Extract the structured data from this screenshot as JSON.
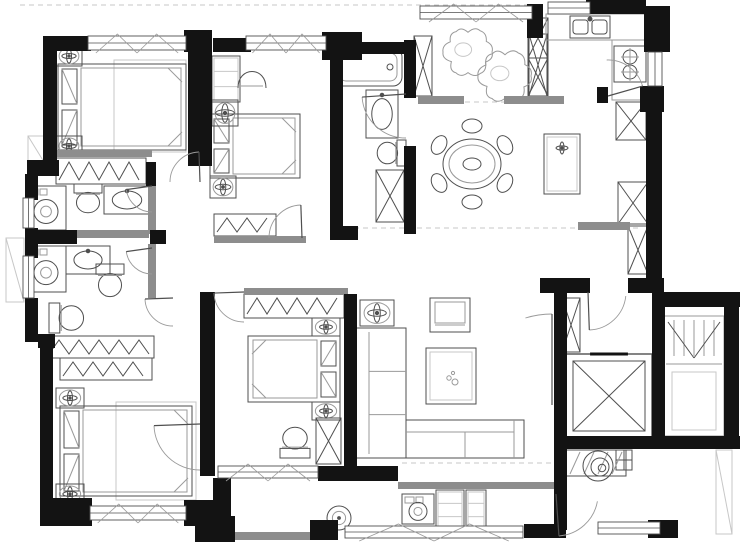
{
  "meta": {
    "canvas_w": 740,
    "canvas_h": 550,
    "drawing_type": "apartment-floor-plan"
  },
  "palette": {
    "wall": "#131313",
    "gray": "#8d8d8d",
    "line": "#4f4f4f",
    "light": "#9a9a9a",
    "faint": "#c7c7c7",
    "white": "#ffffff"
  },
  "dashes": [
    [
      20,
      5,
      528,
      5
    ],
    [
      345,
      228,
      642,
      228
    ],
    [
      420,
      102,
      510,
      102
    ],
    [
      402,
      463,
      552,
      463
    ]
  ],
  "walls": [
    [
      43,
      36,
      48,
      15
    ],
    [
      43,
      36,
      14,
      128
    ],
    [
      27,
      160,
      32,
      16
    ],
    [
      25,
      174,
      13,
      26
    ],
    [
      25,
      228,
      13,
      30
    ],
    [
      25,
      298,
      13,
      44
    ],
    [
      25,
      230,
      52,
      14
    ],
    [
      150,
      230,
      16,
      14
    ],
    [
      38,
      334,
      17,
      14
    ],
    [
      40,
      340,
      13,
      164
    ],
    [
      40,
      498,
      52,
      28
    ],
    [
      184,
      500,
      30,
      26
    ],
    [
      146,
      162,
      10,
      24
    ],
    [
      184,
      30,
      28,
      22
    ],
    [
      188,
      36,
      24,
      130
    ],
    [
      213,
      38,
      38,
      14
    ],
    [
      322,
      32,
      40,
      28
    ],
    [
      330,
      48,
      13,
      186
    ],
    [
      342,
      42,
      66,
      12
    ],
    [
      404,
      40,
      12,
      58
    ],
    [
      404,
      146,
      12,
      88
    ],
    [
      330,
      226,
      28,
      14
    ],
    [
      527,
      4,
      16,
      34
    ],
    [
      586,
      0,
      60,
      14
    ],
    [
      644,
      6,
      26,
      46
    ],
    [
      640,
      86,
      24,
      26
    ],
    [
      646,
      90,
      16,
      192
    ],
    [
      540,
      278,
      50,
      15
    ],
    [
      628,
      278,
      36,
      15
    ],
    [
      554,
      292,
      13,
      66
    ],
    [
      554,
      352,
      13,
      90
    ],
    [
      554,
      436,
      112,
      13
    ],
    [
      652,
      304,
      13,
      136
    ],
    [
      652,
      292,
      88,
      15
    ],
    [
      724,
      304,
      15,
      138
    ],
    [
      664,
      436,
      76,
      13
    ],
    [
      554,
      448,
      13,
      82
    ],
    [
      648,
      520,
      30,
      18
    ],
    [
      597,
      87,
      11,
      16
    ],
    [
      200,
      292,
      15,
      184
    ],
    [
      344,
      294,
      13,
      176
    ],
    [
      318,
      466,
      80,
      15
    ],
    [
      213,
      478,
      18,
      46
    ],
    [
      195,
      516,
      40,
      26
    ],
    [
      310,
      520,
      28,
      20
    ],
    [
      524,
      524,
      42,
      14
    ]
  ],
  "gray_walls": [
    [
      148,
      184,
      8,
      50
    ],
    [
      77,
      230,
      72,
      8
    ],
    [
      148,
      244,
      8,
      54
    ],
    [
      56,
      150,
      96,
      7
    ],
    [
      214,
      236,
      92,
      7
    ],
    [
      244,
      288,
      104,
      7
    ],
    [
      418,
      96,
      46,
      8
    ],
    [
      504,
      96,
      60,
      8
    ],
    [
      578,
      222,
      52,
      8
    ],
    [
      398,
      482,
      160,
      7
    ],
    [
      233,
      532,
      80,
      8
    ]
  ],
  "windows": [
    {
      "n": "window-bedroom-1",
      "x": 88,
      "y": 36,
      "w": 98,
      "h": 14,
      "tick": true
    },
    {
      "n": "window-bedroom-2",
      "x": 246,
      "y": 36,
      "w": 80,
      "h": 14,
      "tick": true
    },
    {
      "n": "window-balcony-top",
      "x": 420,
      "y": 6,
      "w": 112,
      "h": 13,
      "tick": true
    },
    {
      "n": "window-kitchen-top",
      "x": 548,
      "y": 2,
      "w": 42,
      "h": 12
    },
    {
      "n": "window-kitchen-right",
      "x": 648,
      "y": 52,
      "w": 14,
      "h": 34,
      "v": true
    },
    {
      "n": "window-bath-a",
      "x": 23,
      "y": 198,
      "w": 11,
      "h": 30,
      "v": true
    },
    {
      "n": "window-bath-b",
      "x": 23,
      "y": 256,
      "w": 11,
      "h": 42,
      "v": true
    },
    {
      "n": "window-bedroom-3",
      "x": 90,
      "y": 506,
      "w": 96,
      "h": 14,
      "tick": true
    },
    {
      "n": "window-balcony-bottom",
      "x": 345,
      "y": 526,
      "w": 178,
      "h": 12,
      "tick": true
    },
    {
      "n": "window-lobby-bottom",
      "x": 598,
      "y": 522,
      "w": 62,
      "h": 12
    },
    {
      "n": "window-master-balcony",
      "x": 218,
      "y": 466,
      "w": 100,
      "h": 12,
      "tick": true
    }
  ],
  "doors": [
    {
      "n": "door-bedroom-1",
      "cx": 200,
      "cy": 182,
      "r": 30,
      "a0": 180,
      "a1": 268
    },
    {
      "n": "door-bath-a",
      "cx": 152,
      "cy": 186,
      "r": 26,
      "a0": 90,
      "a1": 172
    },
    {
      "n": "door-bath-b",
      "cx": 152,
      "cy": 248,
      "r": 26,
      "a0": 90,
      "a1": 172
    },
    {
      "n": "door-dressing",
      "cx": 173,
      "cy": 298,
      "r": 28,
      "a0": 90,
      "a1": 178
    },
    {
      "n": "door-bedroom-2",
      "cx": 302,
      "cy": 238,
      "r": 33,
      "a0": 180,
      "a1": 268
    },
    {
      "n": "door-bath-2",
      "cx": 406,
      "cy": 94,
      "r": 44,
      "a0": 90,
      "a1": 176
    },
    {
      "n": "door-kitchen",
      "cx": 608,
      "cy": 96,
      "r": 36,
      "a0": 268,
      "a1": 344
    },
    {
      "n": "door-master",
      "cx": 244,
      "cy": 292,
      "r": 30,
      "a0": 90,
      "a1": 178
    },
    {
      "n": "door-bedroom-3",
      "cx": 200,
      "cy": 424,
      "r": 46,
      "a0": 90,
      "a1": 178
    },
    {
      "n": "door-entry",
      "cx": 588,
      "cy": 292,
      "r": 38,
      "a0": 6,
      "a1": 88
    },
    {
      "n": "door-living-lobby",
      "cx": 552,
      "cy": 405,
      "r": 91,
      "a0": 253,
      "a1": 270
    },
    {
      "n": "door-lobby-lower",
      "cx": 556,
      "cy": 494,
      "r": 42,
      "a0": 10,
      "a1": 86
    }
  ],
  "items": [
    {
      "t": "platform",
      "n": "exterior-ledge-left-upper",
      "x": 28,
      "y": 136,
      "w": 16,
      "h": 26
    },
    {
      "t": "platform",
      "n": "exterior-ledge-left-lower",
      "x": 6,
      "y": 238,
      "w": 18,
      "h": 64
    },
    {
      "t": "platform",
      "n": "exterior-ledge-right",
      "x": 716,
      "y": 450,
      "w": 16,
      "h": 84
    },
    {
      "t": "rug",
      "n": "rug-bedroom-1",
      "x": 114,
      "y": 60,
      "w": 72,
      "h": 92
    },
    {
      "t": "rug",
      "n": "rug-bedroom-3",
      "x": 116,
      "y": 402,
      "w": 80,
      "h": 98
    },
    {
      "t": "bed",
      "n": "bed-bedroom-1",
      "x": 58,
      "y": 64,
      "w": 128,
      "h": 86,
      "head": "left"
    },
    {
      "t": "bed",
      "n": "bed-bedroom-2",
      "x": 210,
      "y": 114,
      "w": 90,
      "h": 64,
      "head": "left"
    },
    {
      "t": "bed",
      "n": "bed-master",
      "x": 248,
      "y": 336,
      "w": 92,
      "h": 66,
      "head": "right"
    },
    {
      "t": "bed",
      "n": "bed-bedroom-3",
      "x": 60,
      "y": 406,
      "w": 132,
      "h": 90,
      "head": "left"
    },
    {
      "t": "stand",
      "n": "nightstand-br1-top",
      "x": 56,
      "y": 46,
      "w": 26,
      "h": 20
    },
    {
      "t": "stand",
      "n": "nightstand-br1-bottom",
      "x": 56,
      "y": 136,
      "w": 26,
      "h": 20
    },
    {
      "t": "stand",
      "n": "nightstand-br2",
      "x": 210,
      "y": 176,
      "w": 26,
      "h": 22
    },
    {
      "t": "stand",
      "n": "nightstand-master-top",
      "x": 312,
      "y": 318,
      "w": 28,
      "h": 18
    },
    {
      "t": "stand",
      "n": "nightstand-master-bottom",
      "x": 312,
      "y": 402,
      "w": 28,
      "h": 18
    },
    {
      "t": "stand",
      "n": "nightstand-br3-top",
      "x": 56,
      "y": 388,
      "w": 28,
      "h": 20
    },
    {
      "t": "stand",
      "n": "nightstand-br3-bottom",
      "x": 56,
      "y": 484,
      "w": 28,
      "h": 20
    },
    {
      "t": "stand",
      "n": "side-table-living",
      "x": 360,
      "y": 300,
      "w": 34,
      "h": 26
    },
    {
      "t": "cab",
      "n": "desk-bedroom-2",
      "x": 212,
      "y": 56,
      "w": 28,
      "h": 46
    },
    {
      "t": "stand",
      "n": "dresser-bedroom-2",
      "x": 212,
      "y": 100,
      "w": 26,
      "h": 26
    },
    {
      "t": "chair",
      "n": "chair-bedroom-2",
      "x": 238,
      "y": 66,
      "w": 28,
      "h": 22
    },
    {
      "t": "wardrobe",
      "n": "wardrobe-bedroom-1",
      "x": 56,
      "y": 158,
      "w": 90,
      "h": 26
    },
    {
      "t": "wardrobe",
      "n": "wardrobe-bedroom-2",
      "x": 214,
      "y": 214,
      "w": 62,
      "h": 22
    },
    {
      "t": "wardrobe",
      "n": "wardrobe-master",
      "x": 244,
      "y": 294,
      "w": 100,
      "h": 24
    },
    {
      "t": "wardrobe",
      "n": "wardrobe-dressing-top",
      "x": 46,
      "y": 336,
      "w": 108,
      "h": 22
    },
    {
      "t": "wardrobe",
      "n": "wardrobe-dressing-bottom",
      "x": 60,
      "y": 358,
      "w": 92,
      "h": 22
    },
    {
      "t": "xcab",
      "n": "cabinet-bath-2",
      "x": 376,
      "y": 170,
      "w": 28,
      "h": 52
    },
    {
      "t": "xcab",
      "n": "kitchen-column-top",
      "x": 528,
      "y": 18,
      "w": 20,
      "h": 40
    },
    {
      "t": "xcab",
      "n": "kitchen-column-bottom",
      "x": 528,
      "y": 58,
      "w": 20,
      "h": 38
    },
    {
      "t": "xcab",
      "n": "balcony-column-left",
      "x": 414,
      "y": 36,
      "w": 18,
      "h": 60
    },
    {
      "t": "xcab",
      "n": "balcony-column-right",
      "x": 529,
      "y": 34,
      "w": 18,
      "h": 62
    },
    {
      "t": "xcab",
      "n": "dining-cabinet-top",
      "x": 616,
      "y": 102,
      "w": 30,
      "h": 38
    },
    {
      "t": "xcab",
      "n": "dining-cabinet-mid",
      "x": 618,
      "y": 182,
      "w": 30,
      "h": 42
    },
    {
      "t": "xcab",
      "n": "hall-cabinet",
      "x": 628,
      "y": 226,
      "w": 20,
      "h": 48
    },
    {
      "t": "xcab",
      "n": "lobby-column",
      "x": 562,
      "y": 298,
      "w": 18,
      "h": 54
    },
    {
      "t": "xcab",
      "n": "cabinet-master-bath",
      "x": 316,
      "y": 418,
      "w": 25,
      "h": 46
    },
    {
      "t": "toilet",
      "n": "toilet-bath-a",
      "x": 72,
      "y": 184,
      "w": 32,
      "h": 30,
      "rot": 0
    },
    {
      "t": "toilet",
      "n": "toilet-bath-b",
      "x": 94,
      "y": 264,
      "w": 32,
      "h": 34,
      "rot": 0
    },
    {
      "t": "toilet",
      "n": "toilet-dressing",
      "x": 50,
      "y": 300,
      "w": 34,
      "h": 36,
      "rot": 270
    },
    {
      "t": "toilet",
      "n": "toilet-master-bath",
      "x": 278,
      "y": 426,
      "w": 34,
      "h": 32,
      "rot": 180
    },
    {
      "t": "toilet",
      "n": "toilet-bath-2",
      "x": 376,
      "y": 138,
      "w": 30,
      "h": 30,
      "rot": 90
    },
    {
      "t": "vanity",
      "n": "sink-bath-a",
      "x": 104,
      "y": 186,
      "w": 46,
      "h": 28
    },
    {
      "t": "vanity",
      "n": "sink-bath-b",
      "x": 66,
      "y": 246,
      "w": 44,
      "h": 28
    },
    {
      "t": "vanity",
      "n": "sink-bath-2",
      "x": 366,
      "y": 90,
      "w": 32,
      "h": 48
    },
    {
      "t": "washer",
      "n": "washer-bath-a",
      "x": 26,
      "y": 186,
      "w": 40,
      "h": 44
    },
    {
      "t": "washer",
      "n": "washer-bath-b",
      "x": 26,
      "y": 246,
      "w": 40,
      "h": 46
    },
    {
      "t": "washer",
      "n": "washer-balcony",
      "x": 402,
      "y": 494,
      "w": 32,
      "h": 30
    },
    {
      "t": "basin",
      "n": "basin-balcony",
      "x": 324,
      "y": 504,
      "w": 30,
      "h": 28
    },
    {
      "t": "cab",
      "n": "cabinet-balcony-1",
      "x": 436,
      "y": 490,
      "w": 28,
      "h": 40
    },
    {
      "t": "cab",
      "n": "cabinet-balcony-2",
      "x": 466,
      "y": 490,
      "w": 20,
      "h": 40
    },
    {
      "t": "gridcab",
      "n": "cabinet-lobby",
      "x": 616,
      "y": 450,
      "w": 16,
      "h": 20
    },
    {
      "t": "tub",
      "n": "bathtub-bath-2",
      "x": 334,
      "y": 48,
      "w": 68,
      "h": 38
    },
    {
      "t": "counter",
      "n": "kitchen-counter-top",
      "x": 546,
      "y": 14,
      "w": 100,
      "h": 26
    },
    {
      "t": "counter",
      "n": "kitchen-counter-right",
      "x": 612,
      "y": 40,
      "w": 36,
      "h": 60
    },
    {
      "t": "ksink",
      "n": "kitchen-sink",
      "x": 570,
      "y": 16,
      "w": 40,
      "h": 22
    },
    {
      "t": "stove",
      "n": "stove",
      "x": 614,
      "y": 46,
      "w": 32,
      "h": 36
    },
    {
      "t": "dtable",
      "n": "dining-table",
      "cx": 472,
      "cy": 164,
      "r": 27
    },
    {
      "t": "console",
      "n": "console-dining",
      "x": 544,
      "y": 134,
      "w": 36,
      "h": 60
    },
    {
      "t": "sofa",
      "n": "sofa",
      "x": 356,
      "y": 328,
      "w": 50,
      "h": 130,
      "ext": [
        406,
        420,
        118,
        38
      ]
    },
    {
      "t": "ctable",
      "n": "coffee-table",
      "x": 426,
      "y": 348,
      "w": 50,
      "h": 56
    },
    {
      "t": "armchair",
      "n": "armchair-living",
      "x": 430,
      "y": 298,
      "w": 40,
      "h": 34
    },
    {
      "t": "bench",
      "n": "bench-lobby",
      "x": 564,
      "y": 450,
      "w": 62,
      "h": 26
    },
    {
      "t": "swirl",
      "n": "decor-lobby",
      "cx": 598,
      "cy": 466,
      "r": 15
    },
    {
      "t": "elevator",
      "n": "elevator",
      "x": 566,
      "y": 354,
      "w": 86,
      "h": 84
    },
    {
      "t": "stairs",
      "n": "stairs",
      "x": 664,
      "y": 316,
      "w": 60,
      "h": 120
    },
    {
      "t": "plant",
      "n": "plant-balcony-1",
      "cx": 468,
      "cy": 52,
      "r": 24
    },
    {
      "t": "plant",
      "n": "plant-balcony-2",
      "cx": 505,
      "cy": 76,
      "r": 26
    }
  ]
}
